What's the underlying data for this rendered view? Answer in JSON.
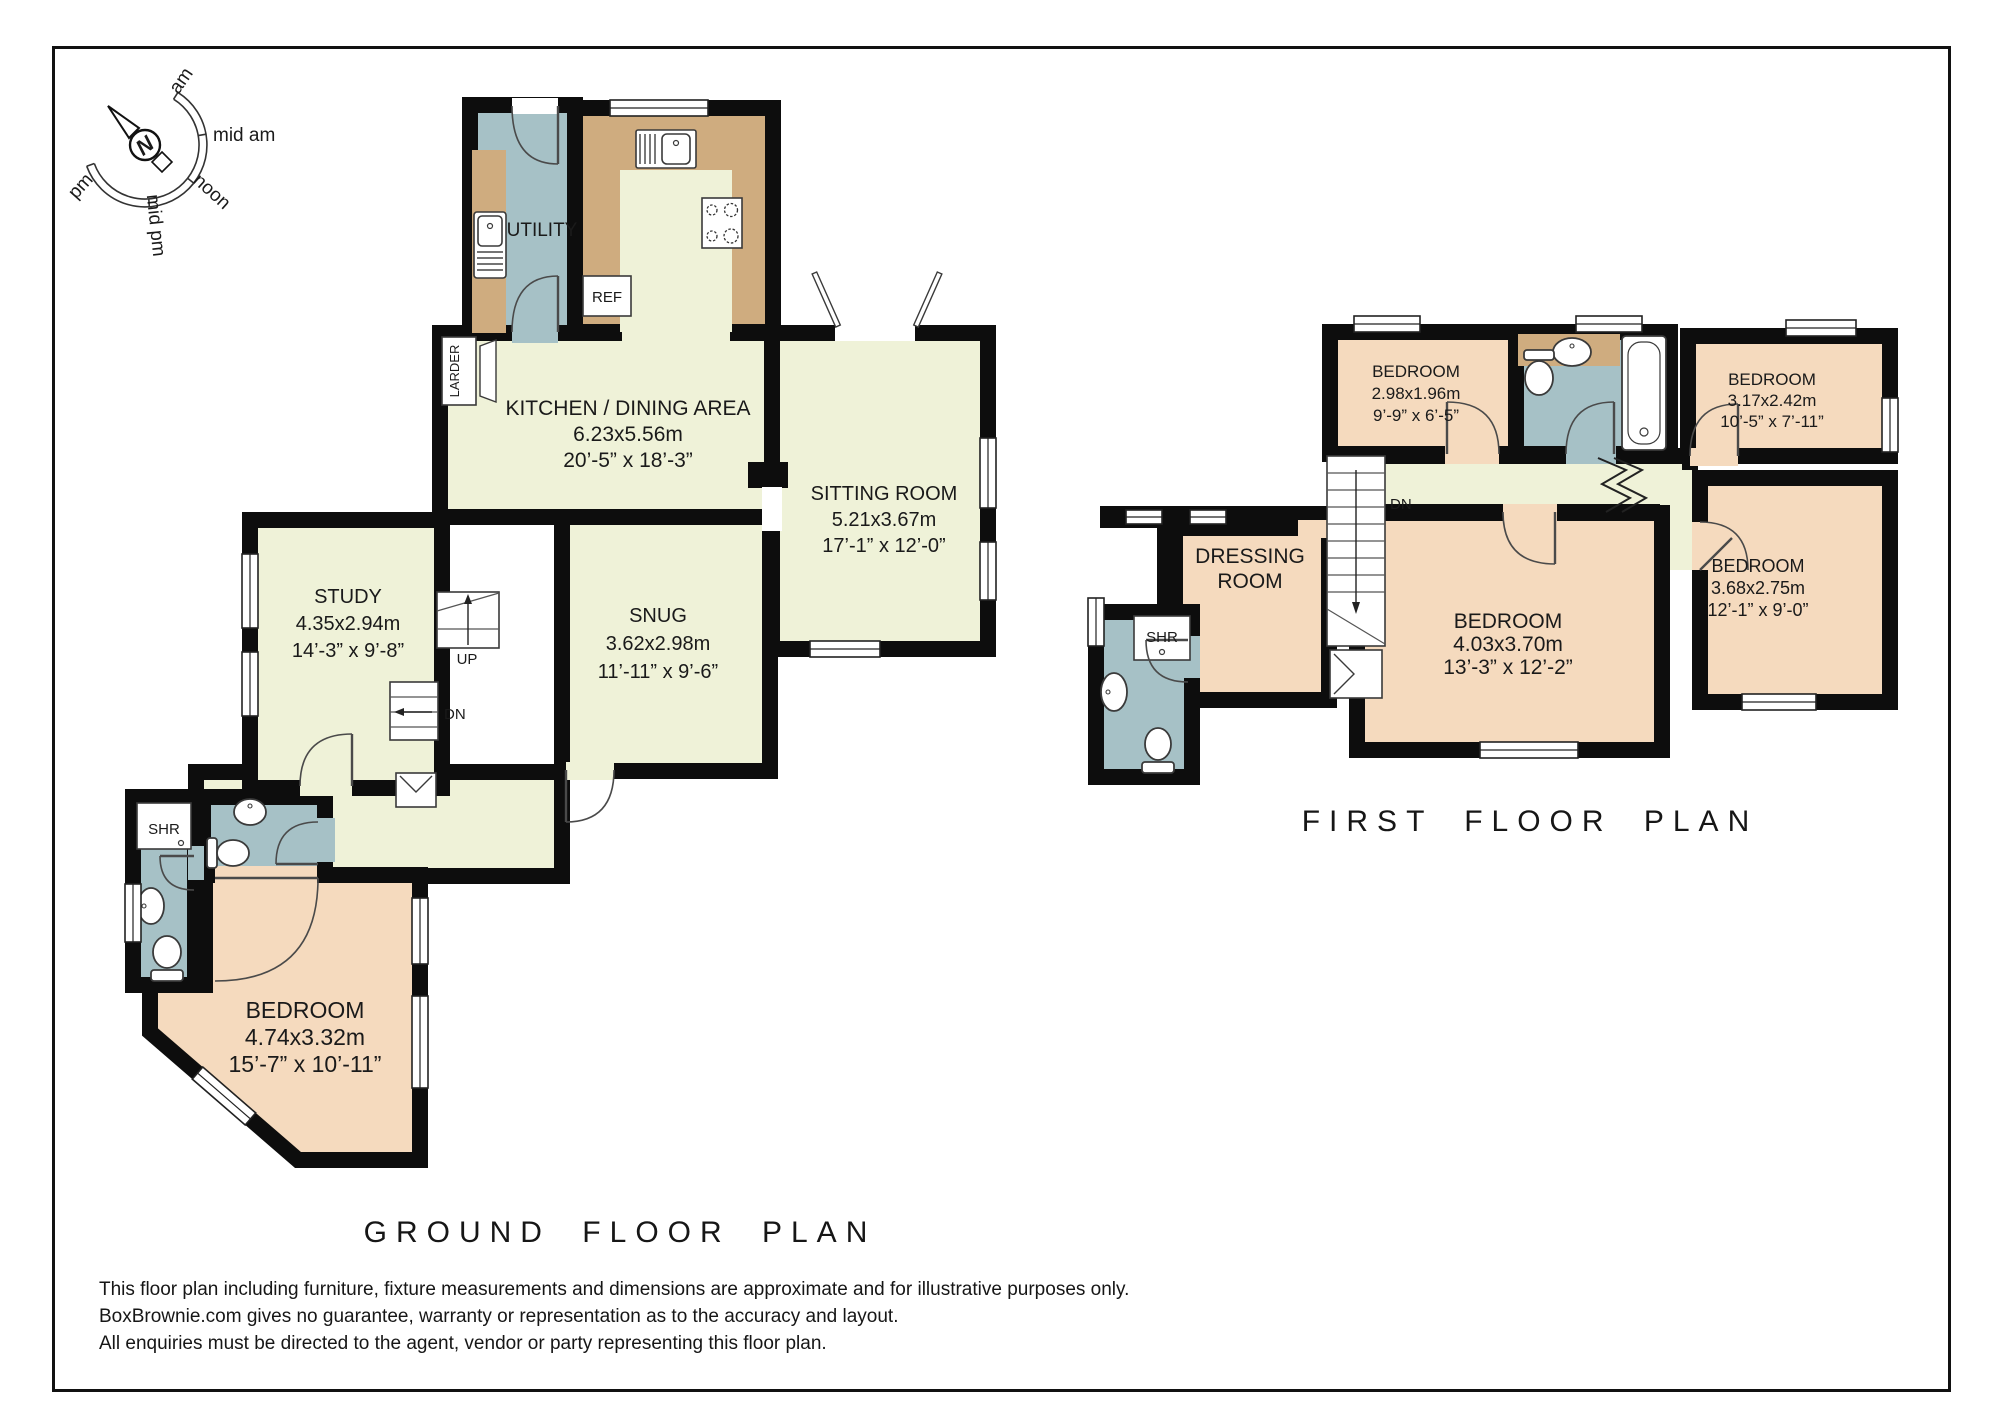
{
  "colors": {
    "wall": "#0d0d0d",
    "floorLiving": "#EFF2D8",
    "floorBedroom": "#F5DABE",
    "floorWet": "#A6C1C6",
    "counter": "#CFAC7F"
  },
  "compass": {
    "north": "N",
    "labels": [
      "am",
      "mid am",
      "noon",
      "mid pm",
      "pm"
    ]
  },
  "ground_floor": {
    "title": "GROUND FLOOR PLAN",
    "utility": "UTILITY",
    "larder": "LARDER",
    "ref": "REF",
    "up": "UP",
    "dn": "DN",
    "shr": "SHR",
    "kitchen": {
      "name": "KITCHEN / DINING AREA",
      "metric": "6.23x5.56m",
      "imperial": "20’-5” x 18’-3”"
    },
    "sitting": {
      "name": "SITTING ROOM",
      "metric": "5.21x3.67m",
      "imperial": "17’-1” x 12’-0”"
    },
    "study": {
      "name": "STUDY",
      "metric": "4.35x2.94m",
      "imperial": "14’-3” x 9’-8”"
    },
    "snug": {
      "name": "SNUG",
      "metric": "3.62x2.98m",
      "imperial": "11’-11” x 9’-6”"
    },
    "bedroom": {
      "name": "BEDROOM",
      "metric": "4.74x3.32m",
      "imperial": "15’-7” x 10’-11”"
    }
  },
  "first_floor": {
    "title": "FIRST FLOOR PLAN",
    "dn": "DN",
    "shr": "SHR",
    "dressing_line1": "DRESSING",
    "dressing_line2": "ROOM",
    "bedroom_small": {
      "name": "BEDROOM",
      "metric": "2.98x1.96m",
      "imperial": "9’-9” x 6’-5”"
    },
    "bedroom_top_right": {
      "name": "BEDROOM",
      "metric": "3.17x2.42m",
      "imperial": "10’-5” x 7’-11”"
    },
    "bedroom_right": {
      "name": "BEDROOM",
      "metric": "3.68x2.75m",
      "imperial": "12’-1” x 9’-0”"
    },
    "bedroom_main": {
      "name": "BEDROOM",
      "metric": "4.03x3.70m",
      "imperial": "13’-3” x 12’-2”"
    }
  },
  "disclaimer": {
    "line1": "This floor plan including furniture, fixture measurements and dimensions are approximate and for illustrative purposes only.",
    "line2": "BoxBrownie.com gives no guarantee, warranty or representation as to the accuracy and layout.",
    "line3": "All enquiries must be directed to the agent, vendor or party representing this floor plan."
  }
}
